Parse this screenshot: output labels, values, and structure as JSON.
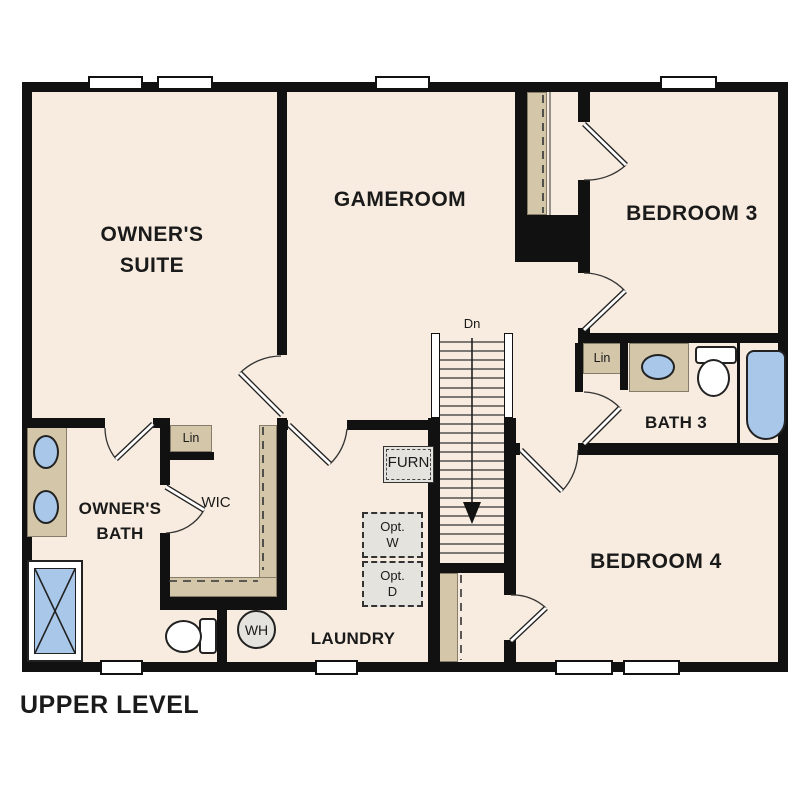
{
  "title": "UPPER LEVEL",
  "rooms": {
    "owners_suite": {
      "line1": "OWNER'S",
      "line2": "SUITE"
    },
    "gameroom": {
      "label": "GAMEROOM"
    },
    "bedroom3": {
      "label": "BEDROOM 3"
    },
    "bath3": {
      "label": "BATH 3"
    },
    "bedroom4": {
      "label": "BEDROOM 4"
    },
    "owners_bath": {
      "line1": "OWNER'S",
      "line2": "BATH"
    },
    "wic": {
      "label": "WIC"
    },
    "laundry": {
      "label": "LAUNDRY"
    }
  },
  "annotations": {
    "stair_direction": "Dn",
    "linen_wic": "Lin",
    "linen_bath3": "Lin",
    "furnace": "FURN",
    "opt_washer": {
      "line1": "Opt.",
      "line2": "W"
    },
    "opt_dryer": {
      "line1": "Opt.",
      "line2": "D"
    },
    "water_heater": "WH"
  },
  "colors": {
    "wall": "#111111",
    "floor": "#f7ecdf",
    "cabinet_tan": "#d3c6a9",
    "fixture_blue": "#a9c8e9",
    "appliance_gray": "#e5e3de"
  }
}
